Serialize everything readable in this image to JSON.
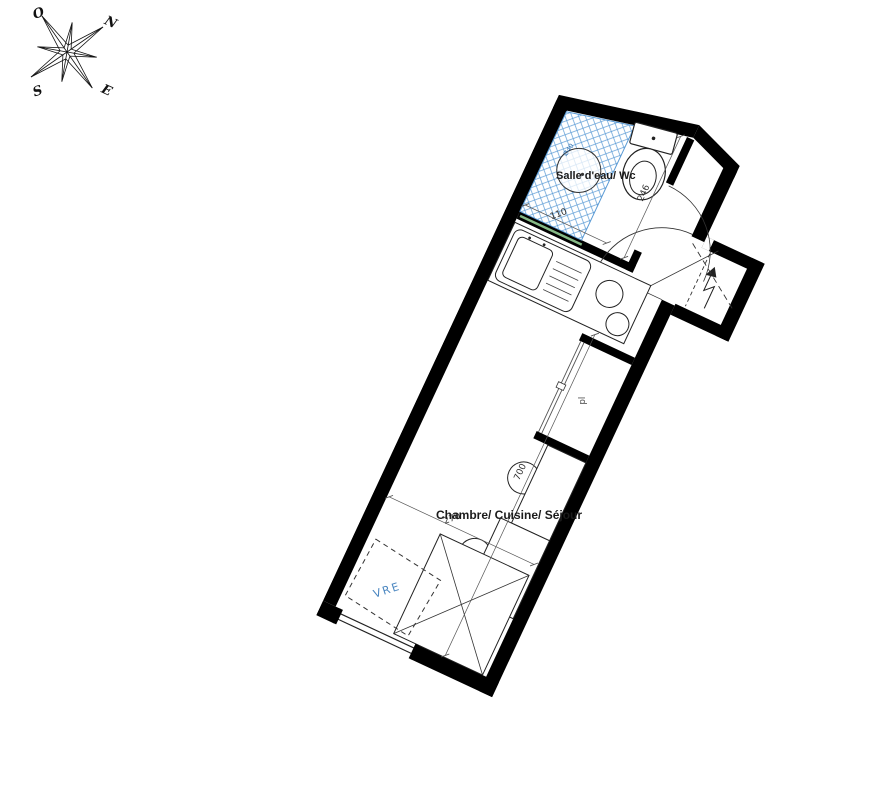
{
  "compass": {
    "north": "N",
    "west": "O",
    "south": "S",
    "east": "E"
  },
  "labels": {
    "bathroom": "Salle d'eau/ Wc",
    "main_room": "Chambre/ Cuisine/ Séjour",
    "closet": "pl",
    "shutter": "VRE",
    "basin_diameter": "Ø40"
  },
  "dimensions": {
    "shower_width": "110",
    "bathroom_length": "246",
    "room_length": "700",
    "room_width": "270"
  },
  "colors": {
    "wall": "#000000",
    "hatch_blue": "#5b9bd5",
    "shutter_blue": "#4a86c0",
    "glass_green": "#86b986",
    "line": "#333333"
  }
}
